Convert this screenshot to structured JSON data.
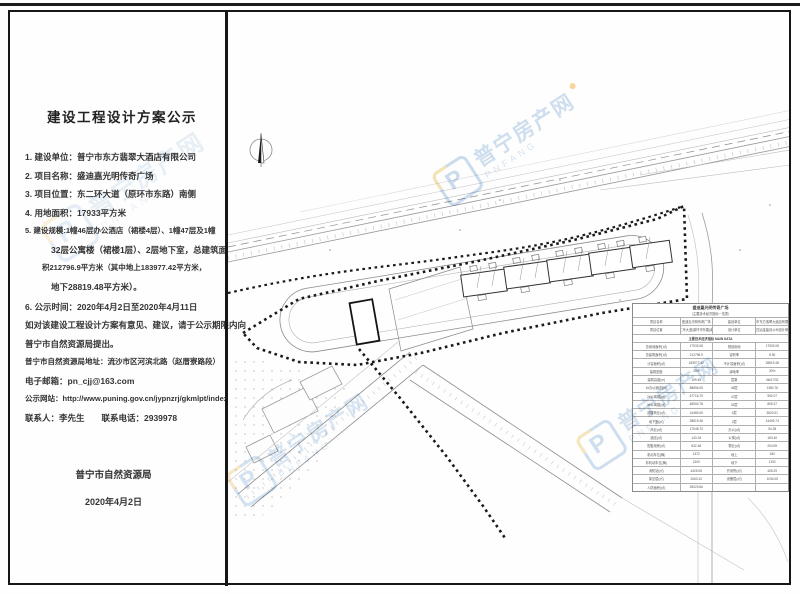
{
  "notice": {
    "title": "建设工程设计方案公示",
    "lines": [
      "1. 建设单位：普宁市东方翡翠大酒店有限公司",
      "2. 项目名称：盛迪嘉光明传奇广场",
      "3. 项目位置：东二环大道（原环市东路）南侧",
      "4. 用地面积：17933平方米"
    ],
    "item5_lines": [
      "5. 建设规模:1幢46层办公酒店（裙楼4层）、1幢47层及1幢",
      "32层公寓楼（裙楼1层）、2层地下室，总建筑面",
      "积212796.9平方米（其中地上183977.42平方米，",
      "地下28819.48平方米）。"
    ],
    "item6": "6. 公示时间：2020年4月2日至2020年4月11日",
    "paras": [
      "如对该建设工程设计方案有意见、建议，请于公示期限内向",
      "普宁市自然资源局提出。",
      "普宁市自然资源局地址：流沙市区河滨北路（赵厝寮路段）",
      "电子邮箱：pn_cjj@163.com",
      "公示网站：http://www.puning.gov.cn/jypnzrj/gkmlpt/index",
      "联系人：李先生　　联系电话：2939978"
    ],
    "signature_org": "普宁市自然资源局",
    "signature_date": "2020年4月2日"
  },
  "watermark": {
    "brand": "普宁房产网",
    "subtitle": "PNFANG",
    "logo_letter": "P",
    "text_color": "#a9c5e1",
    "logo_blue": "#9fc0df",
    "logo_yellow": "#f0cd74"
  },
  "siteplan": {
    "table": {
      "title1": "盛迪嘉光明传奇广场",
      "title2": "（主要技术经济指标一览表）",
      "rows": [
        [
          "项目名称",
          "盛迪嘉光明传奇广场",
          "建设单位",
          "普宁市东方翡翠大酒店有限公司"
        ],
        [
          "项目位置",
          "东二环大道(原环市东路)南侧",
          "设计单位",
          "第十四冶金建设公司设计研究院"
        ],
        [
          "主要技术经济指标 MAIN DATA"
        ],
        [
          "总用地面积(㎡)",
          "17933.08",
          "规划用地",
          "17933.08"
        ],
        [
          "总建筑面积(㎡)",
          "212796.9",
          "容积率",
          "8.90"
        ],
        [
          "计容面积(㎡)",
          "183977.42",
          "不计容面积(㎡)",
          "28819.48"
        ],
        [
          "建筑密度",
          "25%",
          "绿地率",
          "30%"
        ],
        [
          "建筑高度(m)",
          "199.45",
          "层数",
          "46/47/32"
        ],
        [
          "1#办公酒店(㎡)",
          "88896.05",
          "46层",
          "1380.76"
        ],
        [
          "2#公寓楼(㎡)",
          "67716.79",
          "47层",
          "952.07"
        ],
        [
          "3#公寓楼(㎡)",
          "48504.78",
          "32层",
          "805.37"
        ],
        [
          "裙楼商业(㎡)",
          "14480.05",
          "4层",
          "3620.01"
        ],
        [
          "地下室(㎡)",
          "28819.48",
          "2层",
          "14409.74"
        ],
        [
          "商业(㎡)",
          "17048.70",
          "办公(㎡)",
          "54.28"
        ],
        [
          "酒店(㎡)",
          "143.34",
          "公寓(㎡)",
          "163.40"
        ],
        [
          "配套用房(㎡)",
          "632.48",
          "物业(㎡)",
          "204.95"
        ],
        [
          "机动车位(辆)",
          "1372",
          "地上",
          "180"
        ],
        [
          "非机动车位(辆)",
          "2100",
          "地下",
          "1192"
        ],
        [
          "消防站(㎡)",
          "4425.05",
          "开闭所(㎡)",
          "405.29"
        ],
        [
          "架空层(㎡)",
          "2063.10",
          "设备层(㎡)",
          "1034.05"
        ],
        [
          "人防面积(㎡)",
          "26023.66",
          "",
          ""
        ]
      ]
    }
  }
}
